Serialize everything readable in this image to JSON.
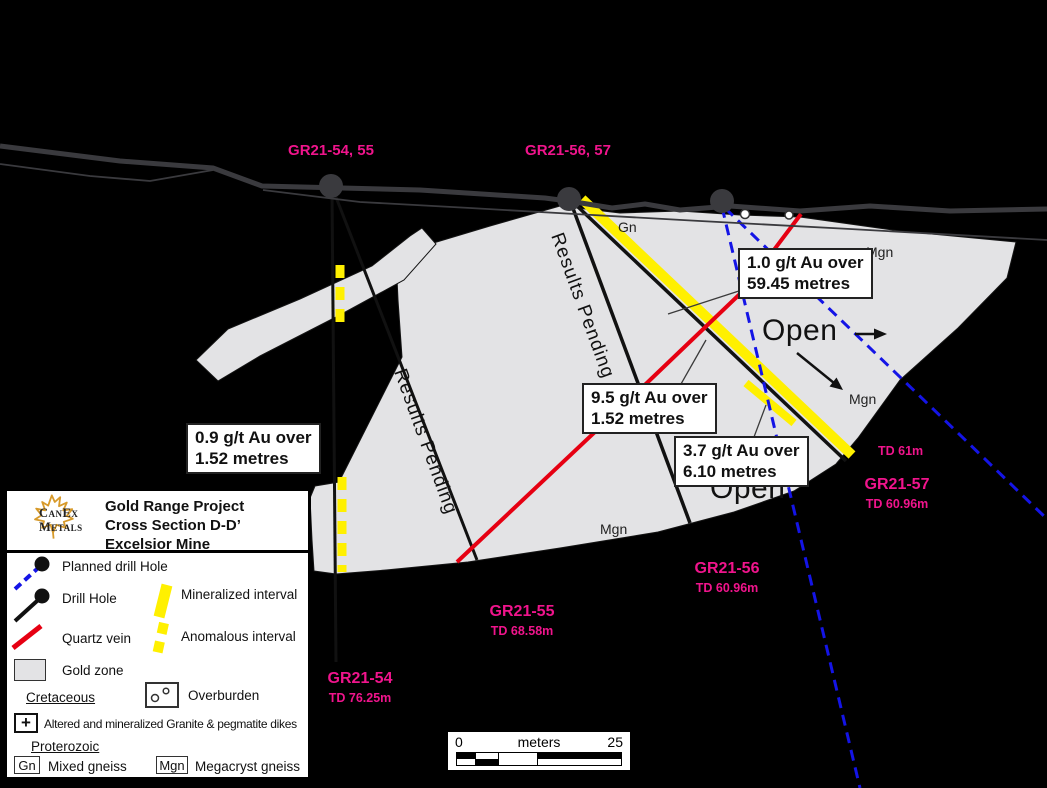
{
  "section": {
    "collar_labels": [
      "GR21-54, 55",
      "GR21-56, 57"
    ],
    "rock_labels": {
      "gn": "Gn",
      "mgn": "Mgn"
    },
    "open_label": "Open",
    "results_pending": "Results Pending",
    "holes": [
      {
        "name": "GR21-54",
        "td": "TD 76.25m"
      },
      {
        "name": "GR21-55",
        "td": "TD 68.58m"
      },
      {
        "name": "GR21-56",
        "td": "TD 60.96m"
      },
      {
        "name": "GR21-57",
        "td": "TD 60.96m"
      }
    ],
    "td_tip_label": "TD 61m",
    "annotations": [
      {
        "line1": "1.0 g/t Au over",
        "line2": "59.45 metres"
      },
      {
        "line1": "9.5 g/t Au over",
        "line2": "1.52 metres"
      },
      {
        "line1": "3.7 g/t Au over",
        "line2": "6.10 metres"
      },
      {
        "line1": "0.9 g/t Au over",
        "line2": "1.52 metres"
      }
    ]
  },
  "legend": {
    "logo": {
      "brand_line1": "CanEx",
      "brand_line2": "Metals"
    },
    "title_line1": "Gold Range Project",
    "title_line2": "Cross Section D-D’",
    "title_line3": "Excelsior Mine",
    "items": {
      "planned_drill_hole": "Planned drill Hole",
      "drill_hole": "Drill Hole",
      "mineralized": "Mineralized interval",
      "quartz_vein": "Quartz vein",
      "anomalous": "Anomalous interval",
      "gold_zone": "Gold zone",
      "cretaceous": "Cretaceous",
      "overburden": "Overburden",
      "granite": "Altered and mineralized Granite & pegmatite dikes",
      "proterozoic": "Proterozoic",
      "gn_abbr": "Gn",
      "gn_label": "Mixed gneiss",
      "mgn_abbr": "Mgn",
      "mgn_label": "Megacryst gneiss"
    }
  },
  "scalebar": {
    "start": "0",
    "unit": "meters",
    "end": "25"
  },
  "colors": {
    "background": "#000000",
    "pink": "#F0148C",
    "planned_blue": "#1414E6",
    "quartz_red": "#E60012",
    "interval_yellow": "#FFF000",
    "gold_zone_gray": "#E3E3E5",
    "surface_gray": "#3A3A3E",
    "logo_gold": "#D79A2B"
  }
}
